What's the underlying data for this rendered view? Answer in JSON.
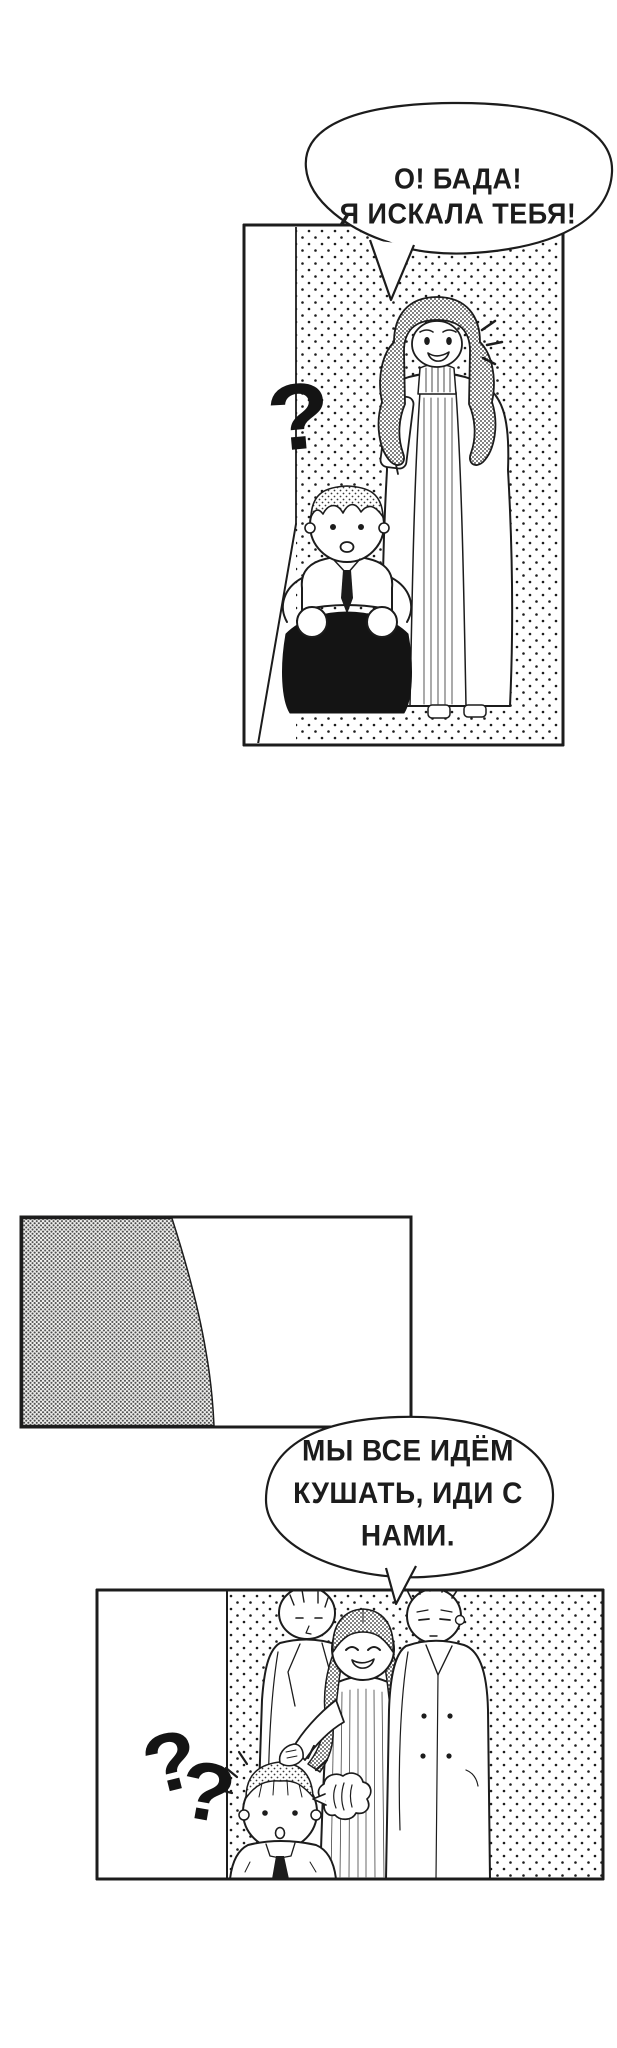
{
  "comic": {
    "paper_color": "#ffffff",
    "ink_color": "#1c1c1c",
    "bubble1": {
      "line1": "О! БАДА!",
      "line2": "Я ИСКАЛА ТЕБЯ!"
    },
    "bubble2": {
      "line1": "МЫ ВСЕ ИДЁМ",
      "line2": "КУШАТЬ, ИДИ С",
      "line3": "НАМИ."
    },
    "panel1_question_mark": "?",
    "panel3_question_mark_1": "?",
    "panel3_question_mark_2": "?"
  }
}
